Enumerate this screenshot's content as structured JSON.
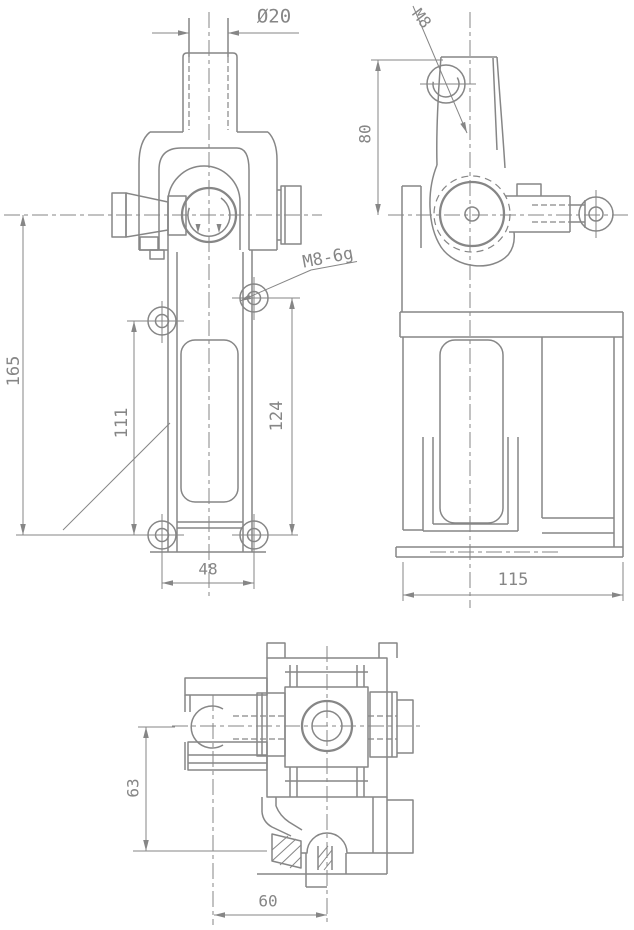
{
  "drawing": {
    "background_color": "#ffffff",
    "line_color": "#868686",
    "front_view": {
      "shaft_diameter": "Ø20",
      "thread_callout": "M8-6g",
      "overall_height": "165",
      "left_hole_spacing": "111",
      "right_hole_spacing": "124",
      "bottom_hole_spacing": "48"
    },
    "side_view": {
      "top_thread": "M8",
      "arm_height": "80",
      "base_width": "115"
    },
    "plan_view": {
      "vertical_offset": "63",
      "horizontal_offset": "60"
    }
  }
}
